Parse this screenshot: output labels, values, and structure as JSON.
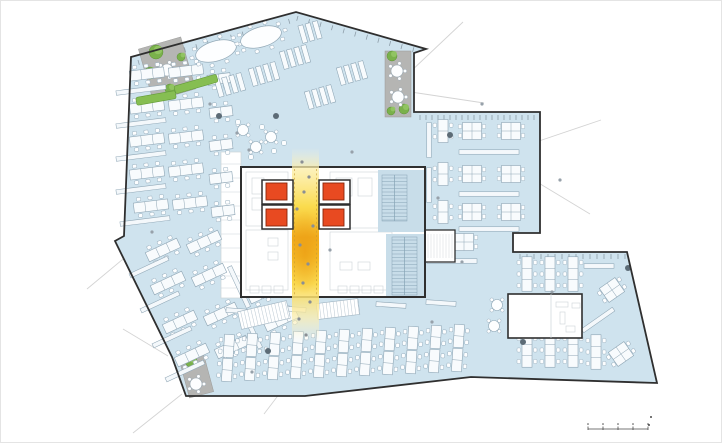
{
  "meta": {
    "width": 722,
    "height": 443
  },
  "palette": {
    "bg": "#ffffff",
    "frame": "#e4e4e4",
    "wall": "#2f2f2f",
    "floor": "#cfe3ee",
    "floor_core_blue": "#c8dde9",
    "desk_fill": "#f8fbfd",
    "desk_stroke": "#8fa6b5",
    "chair_stroke": "#9ab0bf",
    "cabinet_fill": "#f4f8fb",
    "terrace": "#b5b5b3",
    "tree_fill": "#7ab14b",
    "tree_fill2": "#93c765",
    "tree_stroke": "#5d9137",
    "hedge": "#86be52",
    "hedge_stroke": "#639a3a",
    "elevator_red": "#e84a21",
    "elevator_stroke": "#8a2508",
    "stair_hatch": "#86a4b5",
    "core_light": "#ccd3d8",
    "atrium_pale": "#fdf6d4",
    "atrium_mid": "#fada45",
    "atrium_hot": "#f1ab1c",
    "atrium_glow": "#e89610",
    "dash": "#c69b2e",
    "leader": "#cccccc",
    "people": "#97a1aa",
    "people_atrium": "#8a8f94",
    "plant": "#5c6b76",
    "mullion": "#7e8d98",
    "scale": "#4a4a4a"
  },
  "footprint": [
    [
      131,
      57
    ],
    [
      296,
      12
    ],
    [
      426,
      49
    ],
    [
      414,
      53
    ],
    [
      414,
      112
    ],
    [
      540,
      112
    ],
    [
      540,
      233
    ],
    [
      513,
      233
    ],
    [
      513,
      252
    ],
    [
      627,
      252
    ],
    [
      657,
      383
    ],
    [
      471,
      377
    ],
    [
      305,
      396
    ],
    [
      186,
      396
    ],
    [
      172,
      357
    ],
    [
      115,
      241
    ],
    [
      124,
      236
    ]
  ],
  "leader_lines": [
    [
      408,
      74,
      463,
      22
    ],
    [
      411,
      92,
      484,
      103
    ],
    [
      536,
      142,
      601,
      120
    ],
    [
      537,
      182,
      590,
      214
    ],
    [
      140,
      245,
      87,
      289
    ],
    [
      168,
      356,
      123,
      329
    ],
    [
      182,
      394,
      133,
      433
    ],
    [
      280,
      393,
      264,
      414
    ]
  ],
  "mullion_rows": [
    [
      420,
      115,
      538,
      115,
      6
    ],
    [
      520,
      254,
      626,
      254,
      7
    ],
    [
      138,
      60,
      292,
      18,
      12
    ],
    [
      298,
      16,
      424,
      50,
      12
    ]
  ],
  "terraces": [
    {
      "x": 167,
      "y": 69,
      "w": 44,
      "h": 54,
      "r": -16,
      "trees": [
        [
          156,
          52,
          7
        ],
        [
          150,
          73,
          6
        ],
        [
          170,
          89,
          5
        ],
        [
          181,
          57,
          4
        ]
      ],
      "tables": [
        [
          167,
          70
        ]
      ]
    },
    {
      "x": 398,
      "y": 84,
      "w": 26,
      "h": 66,
      "r": 0,
      "trees": [
        [
          392,
          56,
          5
        ],
        [
          404,
          109,
          5
        ],
        [
          391,
          111,
          4
        ]
      ],
      "tables": [
        [
          397,
          71
        ],
        [
          398,
          97
        ]
      ]
    },
    {
      "x": 196,
      "y": 374,
      "w": 25,
      "h": 43,
      "r": -15,
      "trees": [
        [
          191,
          361,
          6
        ]
      ],
      "tables": [
        [
          196,
          384
        ]
      ]
    }
  ],
  "service_band": {
    "x": 221,
    "y": 152,
    "w": 20,
    "h": 146,
    "lines": [
      164,
      178,
      192,
      206,
      220,
      234,
      248,
      262,
      276,
      288
    ]
  },
  "core": {
    "outer": [
      241,
      167,
      184,
      130
    ],
    "blue_patches": [
      [
        378,
        170,
        46,
        62
      ],
      [
        386,
        234,
        38,
        62
      ]
    ],
    "stairs": [
      [
        382,
        175,
        25,
        46
      ],
      [
        392,
        237,
        25,
        58
      ]
    ],
    "annex": [
      425,
      230,
      30,
      32
    ],
    "rooms": [
      [
        246,
        172,
        42,
        54
      ],
      [
        246,
        230,
        42,
        60
      ],
      [
        330,
        172,
        62,
        56
      ],
      [
        330,
        232,
        62,
        58
      ],
      [
        252,
        178,
        12,
        16
      ],
      [
        252,
        198,
        12,
        12
      ],
      [
        336,
        178,
        16,
        18
      ],
      [
        358,
        178,
        14,
        18
      ],
      [
        268,
        238,
        10,
        8
      ],
      [
        268,
        252,
        10,
        8
      ],
      [
        340,
        262,
        12,
        8
      ],
      [
        358,
        262,
        12,
        8
      ]
    ],
    "booths": [
      [
        250,
        286,
        9,
        7
      ],
      [
        262,
        286,
        9,
        7
      ],
      [
        274,
        286,
        9,
        7
      ],
      [
        338,
        286,
        9,
        7
      ],
      [
        350,
        286,
        9,
        7
      ],
      [
        362,
        286,
        9,
        7
      ],
      [
        374,
        286,
        9,
        7
      ]
    ],
    "shafts": [
      [
        262,
        180,
        31,
        24
      ],
      [
        262,
        205,
        31,
        24
      ],
      [
        319,
        180,
        31,
        24
      ],
      [
        319,
        205,
        31,
        24
      ]
    ],
    "cars": [
      [
        266,
        183,
        21,
        17
      ],
      [
        266,
        209,
        21,
        17
      ],
      [
        323,
        183,
        21,
        17
      ],
      [
        323,
        209,
        21,
        17
      ]
    ]
  },
  "atrium": {
    "x": 292,
    "w": 27,
    "y1": 148,
    "y2": 342,
    "dash_x": [
      294.5,
      316.5
    ],
    "dash_y1": 169,
    "dash_y2": 296,
    "hot": {
      "cx": 305,
      "cy": 252,
      "rx": 16,
      "ry": 42
    }
  },
  "skylights": [
    {
      "x": 264,
      "y": 315,
      "w": 50,
      "h": 18,
      "r": -13
    },
    {
      "x": 338,
      "y": 309,
      "w": 42,
      "h": 16,
      "r": -7
    }
  ],
  "meeting_room": {
    "x": 508,
    "y": 294,
    "w": 74,
    "h": 44,
    "divider_x": 551,
    "details": [
      [
        556,
        302,
        12,
        5
      ],
      [
        560,
        312,
        5,
        12
      ],
      [
        566,
        326,
        9,
        6
      ],
      [
        572,
        303,
        8,
        5
      ]
    ]
  },
  "furniture": {
    "bench3": [
      [
        147,
        74,
        -7
      ],
      [
        186,
        71,
        -7
      ],
      [
        147,
        107,
        -7
      ],
      [
        186,
        104,
        -7
      ],
      [
        147,
        140,
        -7
      ],
      [
        186,
        137,
        -7
      ],
      [
        147,
        173,
        -7
      ],
      [
        186,
        170,
        -7
      ],
      [
        151,
        206,
        -7
      ],
      [
        190,
        203,
        -7
      ],
      [
        163,
        250,
        -25
      ],
      [
        204,
        242,
        -25
      ],
      [
        168,
        283,
        -25
      ],
      [
        209,
        275,
        -25
      ],
      [
        180,
        322,
        -25
      ],
      [
        221,
        314,
        -25
      ],
      [
        192,
        355,
        -25
      ],
      [
        232,
        347,
        -25
      ],
      [
        265,
        292,
        -25
      ],
      [
        281,
        320,
        -25
      ],
      [
        527,
        274,
        90
      ],
      [
        550,
        274,
        90
      ],
      [
        573,
        274,
        90
      ],
      [
        527,
        350,
        90
      ],
      [
        550,
        350,
        90
      ],
      [
        573,
        350,
        90
      ],
      [
        596,
        352,
        90
      ]
    ],
    "bench2": [
      [
        221,
        112,
        -7
      ],
      [
        221,
        145,
        -7
      ],
      [
        221,
        178,
        -7
      ],
      [
        223,
        211,
        -7
      ],
      [
        219,
        79,
        -7
      ],
      [
        256,
        252,
        -25
      ],
      [
        443,
        131,
        90
      ],
      [
        443,
        174,
        90
      ],
      [
        443,
        212,
        90
      ],
      [
        437,
        242,
        90
      ]
    ],
    "cluster4": [
      [
        472,
        131,
        0
      ],
      [
        511,
        131,
        0
      ],
      [
        472,
        174,
        0
      ],
      [
        511,
        174,
        0
      ],
      [
        472,
        212,
        0
      ],
      [
        511,
        212,
        0
      ],
      [
        464,
        242,
        0
      ],
      [
        612,
        290,
        -35
      ],
      [
        621,
        354,
        -35
      ]
    ],
    "cabinet": [
      [
        141,
        90,
        -7,
        50
      ],
      [
        141,
        123,
        -7,
        50
      ],
      [
        141,
        156,
        -7,
        50
      ],
      [
        141,
        189,
        -7,
        50
      ],
      [
        145,
        221,
        -7,
        50
      ],
      [
        149,
        267,
        -25,
        42
      ],
      [
        160,
        302,
        -25,
        42
      ],
      [
        172,
        337,
        -25,
        42
      ],
      [
        185,
        371,
        -25,
        42
      ],
      [
        239,
        287,
        65,
        45
      ],
      [
        252,
        330,
        65,
        40
      ],
      [
        489,
        152,
        0,
        60
      ],
      [
        489,
        194,
        0,
        60
      ],
      [
        489,
        229,
        0,
        60
      ],
      [
        429,
        140,
        90,
        35
      ],
      [
        429,
        185,
        90,
        35
      ],
      [
        452,
        261,
        0,
        50
      ],
      [
        599,
        266,
        0,
        30
      ],
      [
        560,
        322,
        0,
        45
      ],
      [
        598,
        320,
        -35,
        38
      ],
      [
        241,
        311,
        4,
        30
      ],
      [
        291,
        309,
        4,
        30
      ],
      [
        341,
        307,
        4,
        30
      ],
      [
        391,
        305,
        4,
        30
      ],
      [
        441,
        303,
        4,
        30
      ]
    ],
    "vcol": [
      [
        228,
        358,
        4
      ],
      [
        251,
        357,
        4
      ],
      [
        274,
        356,
        4
      ],
      [
        297,
        355,
        4
      ],
      [
        320,
        354,
        4
      ],
      [
        343,
        353,
        4
      ],
      [
        366,
        352,
        4
      ],
      [
        389,
        351,
        4
      ],
      [
        412,
        350,
        4
      ],
      [
        435,
        349,
        4
      ],
      [
        458,
        348,
        4
      ]
    ],
    "stripgroup": [
      [
        230,
        85,
        -16,
        4
      ],
      [
        264,
        74,
        -16,
        4
      ],
      [
        295,
        57,
        -16,
        4
      ],
      [
        310,
        32,
        -16,
        3
      ],
      [
        352,
        73,
        -16,
        4
      ],
      [
        320,
        97,
        -16,
        4
      ]
    ],
    "oval": [
      [
        216,
        51,
        -16
      ],
      [
        261,
        37,
        -16
      ]
    ],
    "round_table": [
      [
        497,
        305
      ],
      [
        494,
        326
      ],
      [
        243,
        130
      ],
      [
        256,
        147
      ],
      [
        271,
        137
      ]
    ],
    "tinysq": [
      [
        238,
        122
      ],
      [
        262,
        127
      ],
      [
        274,
        151
      ],
      [
        251,
        157
      ],
      [
        284,
        143
      ]
    ],
    "hedge": [
      [
        156,
        98,
        -10,
        40
      ],
      [
        196,
        84,
        -16,
        44
      ]
    ]
  },
  "atrium_people": [
    [
      302,
      162
    ],
    [
      309,
      177
    ],
    [
      304,
      192
    ],
    [
      297,
      209
    ],
    [
      313,
      226
    ],
    [
      300,
      245
    ],
    [
      308,
      264
    ],
    [
      303,
      283
    ],
    [
      310,
      302
    ],
    [
      299,
      319
    ],
    [
      306,
      335
    ]
  ],
  "people": [
    [
      237,
      133
    ],
    [
      249,
      150
    ],
    [
      438,
      198
    ],
    [
      352,
      152
    ],
    [
      432,
      322
    ],
    [
      252,
      372
    ],
    [
      152,
      232
    ],
    [
      462,
      262
    ],
    [
      552,
      292
    ],
    [
      210,
      104
    ],
    [
      482,
      104
    ],
    [
      560,
      180
    ],
    [
      330,
      250
    ]
  ],
  "plants": [
    [
      219,
      116
    ],
    [
      276,
      116
    ],
    [
      450,
      135
    ],
    [
      628,
      268
    ],
    [
      268,
      351
    ],
    [
      523,
      342
    ]
  ],
  "scale_bar": {
    "x": 588,
    "y": 429,
    "w": 60,
    "ticks": 5,
    "marks": [
      [
        651,
        417
      ],
      [
        649,
        425
      ]
    ]
  }
}
